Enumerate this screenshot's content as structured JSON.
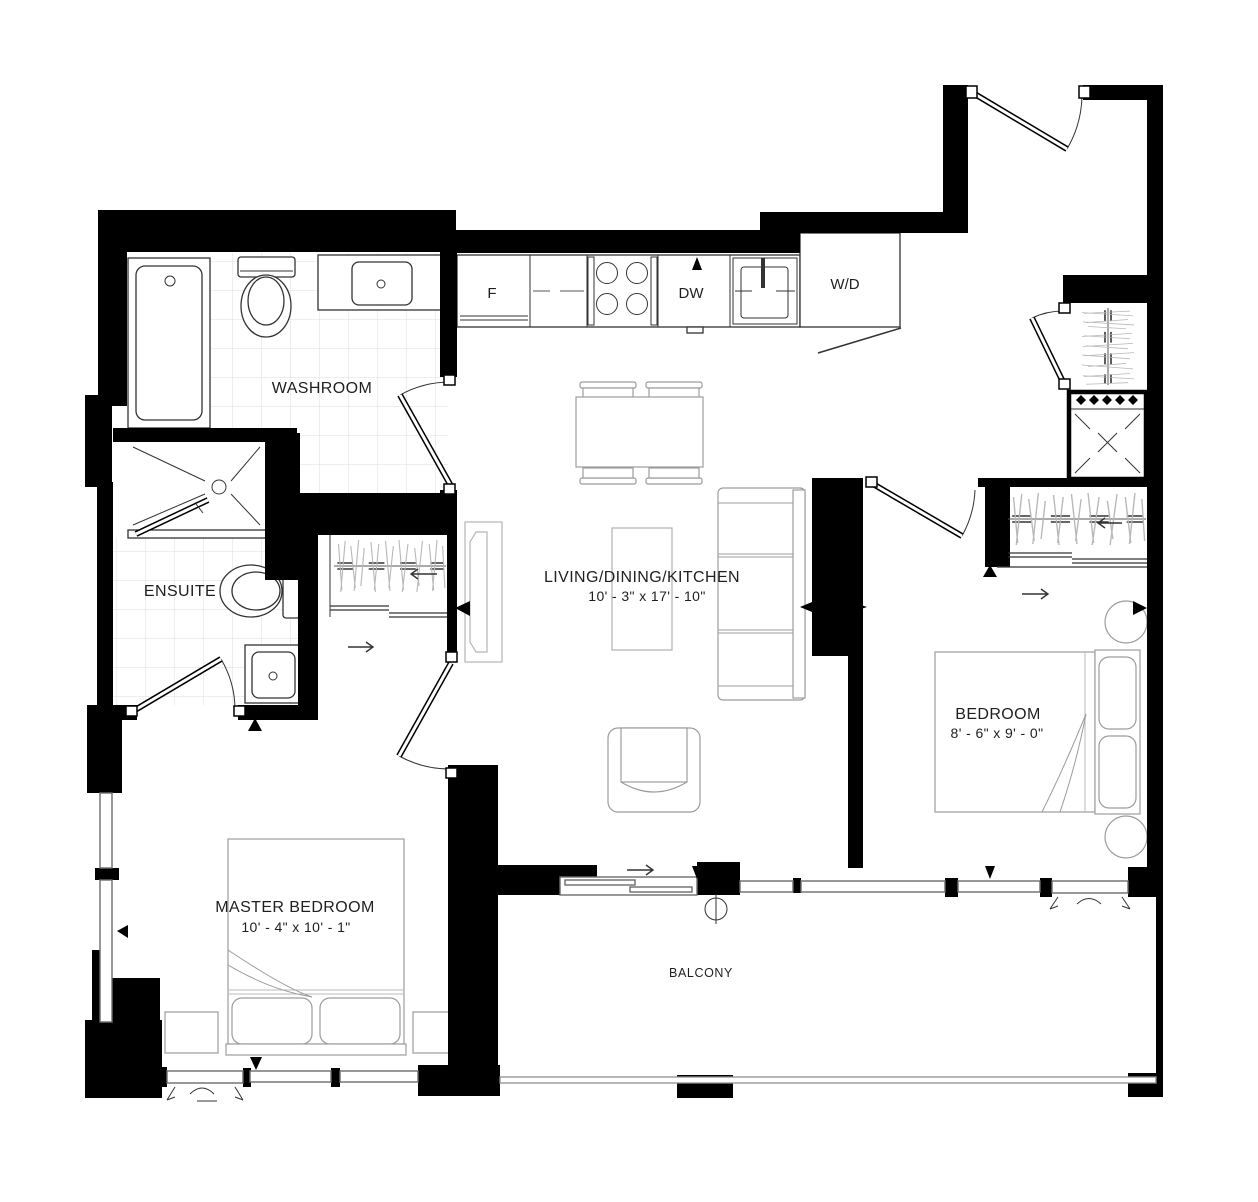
{
  "colors": {
    "walls": "#000000",
    "fixtures": "#333333",
    "furniture": "#9c9c9c",
    "tile_grid": "#dedede",
    "background": "#ffffff"
  },
  "plan": {
    "rooms": {
      "washroom": {
        "label": "WASHROOM"
      },
      "ensuite": {
        "label": "ENSUITE"
      },
      "living": {
        "label": "LIVING/DINING/KITCHEN",
        "dims": "10' - 3\" x 17' - 10\""
      },
      "bedroom": {
        "label": "BEDROOM",
        "dims": "8' - 6\" x 9' - 0\""
      },
      "master": {
        "label": "MASTER BEDROOM",
        "dims": "10' - 4\" x 10' - 1\""
      },
      "balcony": {
        "label": "BALCONY"
      }
    },
    "appliances": {
      "fridge": "F",
      "dishwasher": "DW",
      "washer_dryer": "W/D"
    }
  }
}
